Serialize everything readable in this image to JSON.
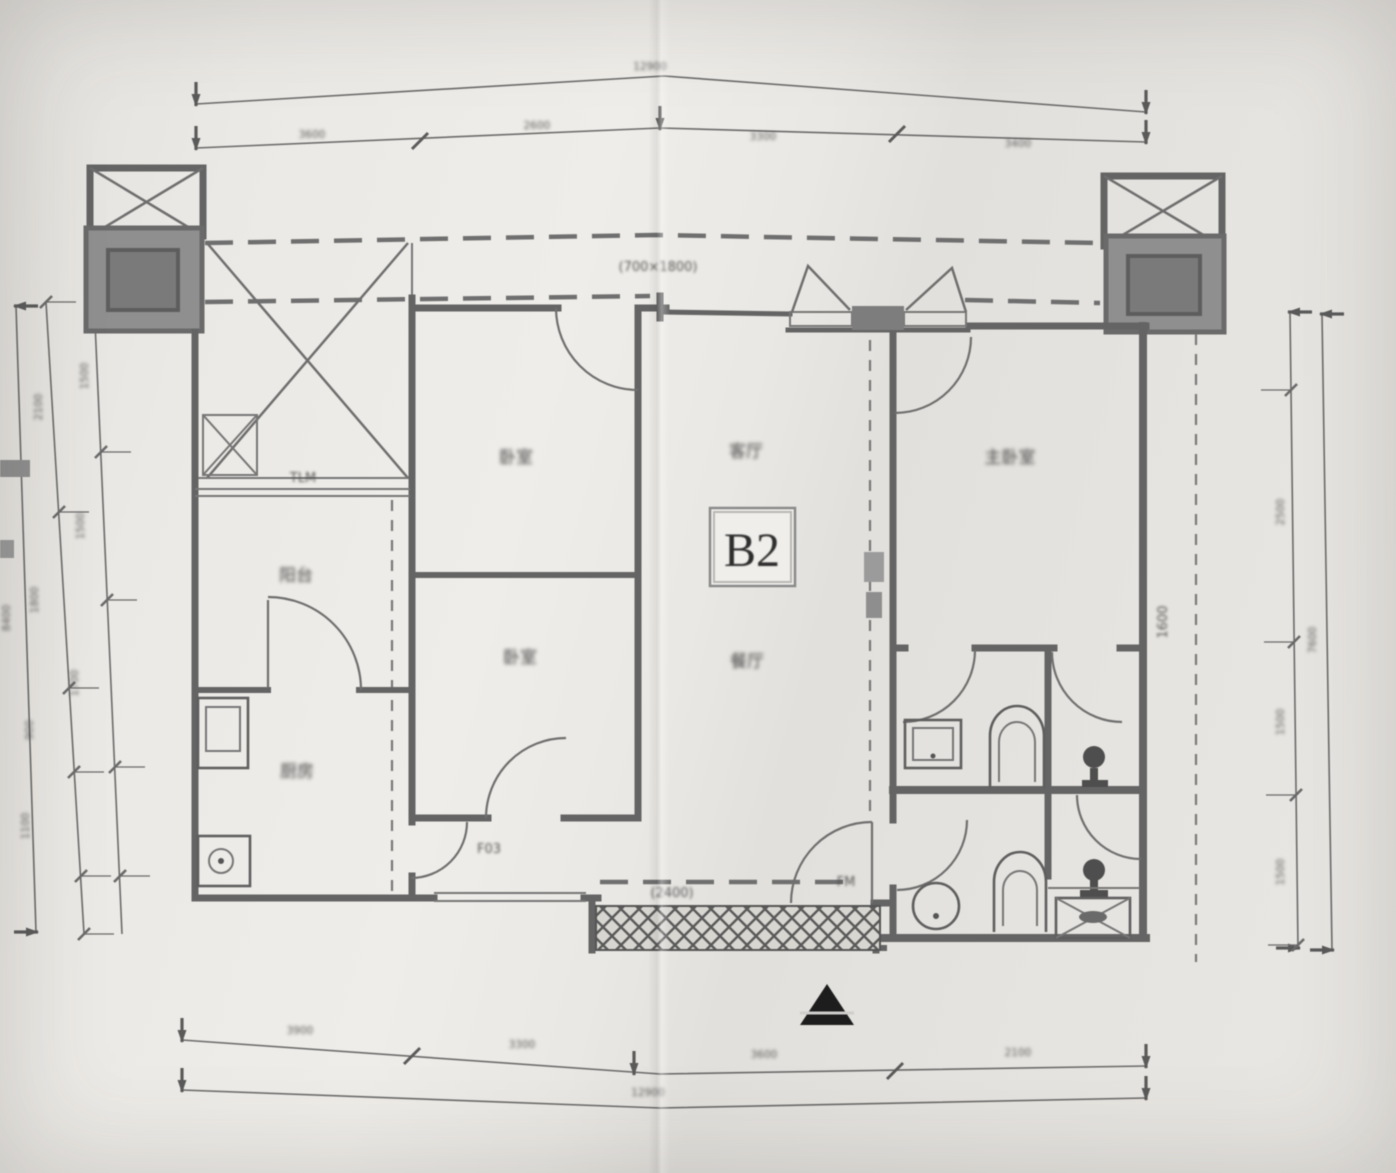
{
  "unit": {
    "label": "B2"
  },
  "rooms": {
    "bedroom_top": "卧室",
    "living": "客厅",
    "master": "主卧室",
    "balcony": "阳台",
    "bedroom_bottom": "卧室",
    "dining": "餐厅",
    "kitchen": "厨房"
  },
  "codes": {
    "sliding_door": "TLM",
    "corridor_window": "F03",
    "entry_door": "FM"
  },
  "annotations": {
    "canopy": "(700×1800)",
    "entry_width": "(2400)",
    "right_side_note": "1600"
  },
  "dimensions": {
    "top": {
      "total": "12900",
      "segments": [
        "3600",
        "2600",
        "3300",
        "3400"
      ]
    },
    "bottom": {
      "total": "12900",
      "segments": [
        "3900",
        "3300",
        "3600",
        "2100"
      ]
    },
    "left": {
      "total": "8400",
      "outer_segments": [
        "2100",
        "1800",
        "900",
        "1100"
      ],
      "inner_segments": [
        "1500",
        "1500",
        "1700"
      ]
    },
    "right": {
      "total": "7600",
      "segments": [
        "2500",
        "1500",
        "1500"
      ]
    }
  }
}
